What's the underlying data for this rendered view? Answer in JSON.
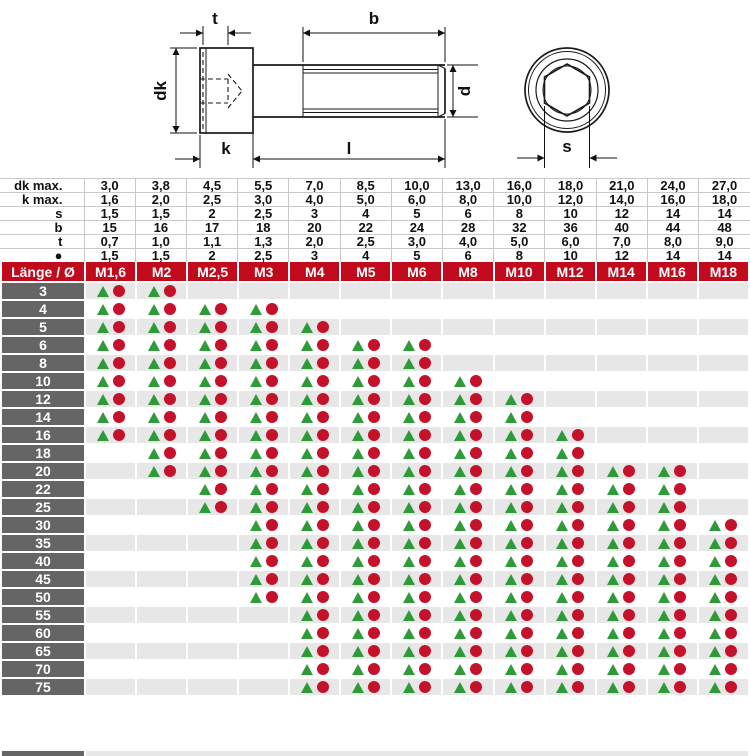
{
  "drawing": {
    "labels": {
      "t": "t",
      "b": "b",
      "dk": "dk",
      "d": "d",
      "k": "k",
      "l": "l",
      "s": "s"
    }
  },
  "spec_table": {
    "rows": [
      {
        "label": "dk max.",
        "values": [
          "3,0",
          "3,8",
          "4,5",
          "5,5",
          "7,0",
          "8,5",
          "10,0",
          "13,0",
          "16,0",
          "18,0",
          "21,0",
          "24,0",
          "27,0"
        ]
      },
      {
        "label": "k max.",
        "values": [
          "1,6",
          "2,0",
          "2,5",
          "3,0",
          "4,0",
          "5,0",
          "6,0",
          "8,0",
          "10,0",
          "12,0",
          "14,0",
          "16,0",
          "18,0"
        ]
      },
      {
        "label": "s",
        "values": [
          "1,5",
          "1,5",
          "2",
          "2,5",
          "3",
          "4",
          "5",
          "6",
          "8",
          "10",
          "12",
          "14",
          "14"
        ]
      },
      {
        "label": "b",
        "values": [
          "15",
          "16",
          "17",
          "18",
          "20",
          "22",
          "24",
          "28",
          "32",
          "36",
          "40",
          "44",
          "48"
        ]
      },
      {
        "label": "t",
        "values": [
          "0,7",
          "1,0",
          "1,1",
          "1,3",
          "2,0",
          "2,5",
          "3,0",
          "4,0",
          "5,0",
          "6,0",
          "7,0",
          "8,0",
          "9,0"
        ]
      },
      {
        "label": "●",
        "values": [
          "1,5",
          "1,5",
          "2",
          "2,5",
          "3",
          "4",
          "5",
          "6",
          "8",
          "10",
          "12",
          "14",
          "14"
        ]
      }
    ]
  },
  "header": {
    "corner": "Länge / Ø",
    "columns": [
      "M1,6",
      "M2",
      "M2,5",
      "M3",
      "M4",
      "M5",
      "M6",
      "M8",
      "M10",
      "M12",
      "M14",
      "M16",
      "M18"
    ]
  },
  "matrix": {
    "marker_meaning": "triangle-and-dot availability markers",
    "rows": [
      {
        "length": "3",
        "available": [
          1,
          1,
          0,
          0,
          0,
          0,
          0,
          0,
          0,
          0,
          0,
          0,
          0
        ]
      },
      {
        "length": "4",
        "available": [
          1,
          1,
          1,
          1,
          0,
          0,
          0,
          0,
          0,
          0,
          0,
          0,
          0
        ]
      },
      {
        "length": "5",
        "available": [
          1,
          1,
          1,
          1,
          1,
          0,
          0,
          0,
          0,
          0,
          0,
          0,
          0
        ]
      },
      {
        "length": "6",
        "available": [
          1,
          1,
          1,
          1,
          1,
          1,
          1,
          0,
          0,
          0,
          0,
          0,
          0
        ]
      },
      {
        "length": "8",
        "available": [
          1,
          1,
          1,
          1,
          1,
          1,
          1,
          0,
          0,
          0,
          0,
          0,
          0
        ]
      },
      {
        "length": "10",
        "available": [
          1,
          1,
          1,
          1,
          1,
          1,
          1,
          1,
          0,
          0,
          0,
          0,
          0
        ]
      },
      {
        "length": "12",
        "available": [
          1,
          1,
          1,
          1,
          1,
          1,
          1,
          1,
          1,
          0,
          0,
          0,
          0
        ]
      },
      {
        "length": "14",
        "available": [
          1,
          1,
          1,
          1,
          1,
          1,
          1,
          1,
          1,
          0,
          0,
          0,
          0
        ]
      },
      {
        "length": "16",
        "available": [
          1,
          1,
          1,
          1,
          1,
          1,
          1,
          1,
          1,
          1,
          0,
          0,
          0
        ]
      },
      {
        "length": "18",
        "available": [
          0,
          1,
          1,
          1,
          1,
          1,
          1,
          1,
          1,
          1,
          0,
          0,
          0
        ]
      },
      {
        "length": "20",
        "available": [
          0,
          1,
          1,
          1,
          1,
          1,
          1,
          1,
          1,
          1,
          1,
          1,
          0
        ]
      },
      {
        "length": "22",
        "available": [
          0,
          0,
          1,
          1,
          1,
          1,
          1,
          1,
          1,
          1,
          1,
          1,
          0
        ]
      },
      {
        "length": "25",
        "available": [
          0,
          0,
          1,
          1,
          1,
          1,
          1,
          1,
          1,
          1,
          1,
          1,
          0
        ]
      },
      {
        "length": "30",
        "available": [
          0,
          0,
          0,
          1,
          1,
          1,
          1,
          1,
          1,
          1,
          1,
          1,
          1
        ]
      },
      {
        "length": "35",
        "available": [
          0,
          0,
          0,
          1,
          1,
          1,
          1,
          1,
          1,
          1,
          1,
          1,
          1
        ]
      },
      {
        "length": "40",
        "available": [
          0,
          0,
          0,
          1,
          1,
          1,
          1,
          1,
          1,
          1,
          1,
          1,
          1
        ]
      },
      {
        "length": "45",
        "available": [
          0,
          0,
          0,
          1,
          1,
          1,
          1,
          1,
          1,
          1,
          1,
          1,
          1
        ]
      },
      {
        "length": "50",
        "available": [
          0,
          0,
          0,
          1,
          1,
          1,
          1,
          1,
          1,
          1,
          1,
          1,
          1
        ]
      },
      {
        "length": "55",
        "available": [
          0,
          0,
          0,
          0,
          1,
          1,
          1,
          1,
          1,
          1,
          1,
          1,
          1
        ]
      },
      {
        "length": "60",
        "available": [
          0,
          0,
          0,
          0,
          1,
          1,
          1,
          1,
          1,
          1,
          1,
          1,
          1
        ]
      },
      {
        "length": "65",
        "available": [
          0,
          0,
          0,
          0,
          1,
          1,
          1,
          1,
          1,
          1,
          1,
          1,
          1
        ]
      },
      {
        "length": "70",
        "available": [
          0,
          0,
          0,
          0,
          1,
          1,
          1,
          1,
          1,
          1,
          1,
          1,
          1
        ]
      },
      {
        "length": "75",
        "available": [
          0,
          0,
          0,
          0,
          1,
          1,
          1,
          1,
          1,
          1,
          1,
          1,
          1
        ]
      }
    ]
  },
  "colors": {
    "header_red": "#c10b1d",
    "label_gray": "#656565",
    "row_alt": "#e7e7e7",
    "triangle_green": "#2e9b38",
    "circle_red": "#c4122a",
    "grid_gray": "#c9c9c9"
  }
}
